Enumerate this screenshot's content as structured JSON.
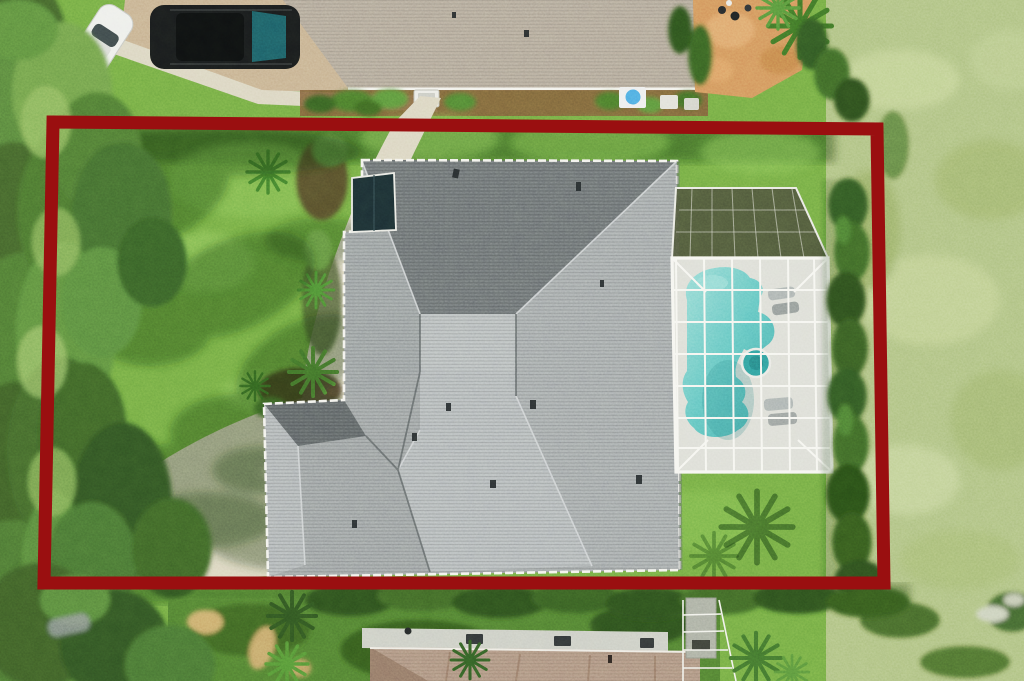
{
  "meta": {
    "type": "aerial-photograph",
    "description": "Overhead drone photo of a single-family home with gray hip roof and screened pool enclosure; a thick dark-red property-boundary rectangle is overlaid on the photo. No text appears in the image.",
    "width_px": 1024,
    "height_px": 681
  },
  "overlay": {
    "name": "property-boundary",
    "color": "#9a0f10",
    "stroke_px": 13,
    "corners": {
      "top_left": [
        53,
        122
      ],
      "top_right": [
        877,
        129
      ],
      "bottom_right": [
        884,
        583
      ],
      "bottom_left": [
        44,
        583
      ]
    }
  },
  "palette": {
    "lawn": "#6FA742",
    "lawn_bright": "#83C055",
    "lawn_shadow": "#1D3A15",
    "field": "#ABBE7F",
    "canopy": "#49682F",
    "hedge": "#2F5220",
    "roof_light": "#B7BCBE",
    "roof_mid": "#9DA2A5",
    "roof_dark": "#6B7074",
    "gutter": "#F2F1EC",
    "walkway": "#D9D3BF",
    "paver_driveway": "#C4AD8D",
    "neighbor_roof_top": "#B1A698",
    "neighbor_roof_bottom": "#AB8F7E",
    "flat_roof": "#C9CBC3",
    "mulch": "#7A5A39",
    "gravel": "#D0905A",
    "pool_deck": "#DBDCD5",
    "cage_frame": "#F5F5F0",
    "screen_mesh": "#4A5039",
    "pool_water": "#5FC2BF",
    "pool_water_light": "#93DAD4",
    "spa_water": "#2E9A9B",
    "atrium_glass": "#1A2B31",
    "car_white": "#ECEDEA",
    "suv_body": "#17191B",
    "suv_glass": "#1B5A63",
    "stone": "#A7ABA0"
  },
  "scene": {
    "subject_lot": {
      "house": "gray asphalt-shingle hip roof with white gutters and roof vents",
      "pool": "freeform turquoise pool with round spa and lounge chairs inside white screened enclosure",
      "front_yard": "lawn with large shade-tree shadows, curved concrete walkway and driveway apron, palm garden beds",
      "rear_right": "trimmed hedge row along east boundary"
    },
    "surroundings": {
      "north": "neighbor with tan shingle roof, paver driveway, white sedan and dark SUV, AC unit, kiddie pool, orange gravel yard",
      "east": "open pale scrubby field",
      "south": "neighbor with brown shingle roof, gray flat lanai roof with skylights, stone chimney, hedges and palms",
      "west": "dense mature tree canopy"
    }
  }
}
